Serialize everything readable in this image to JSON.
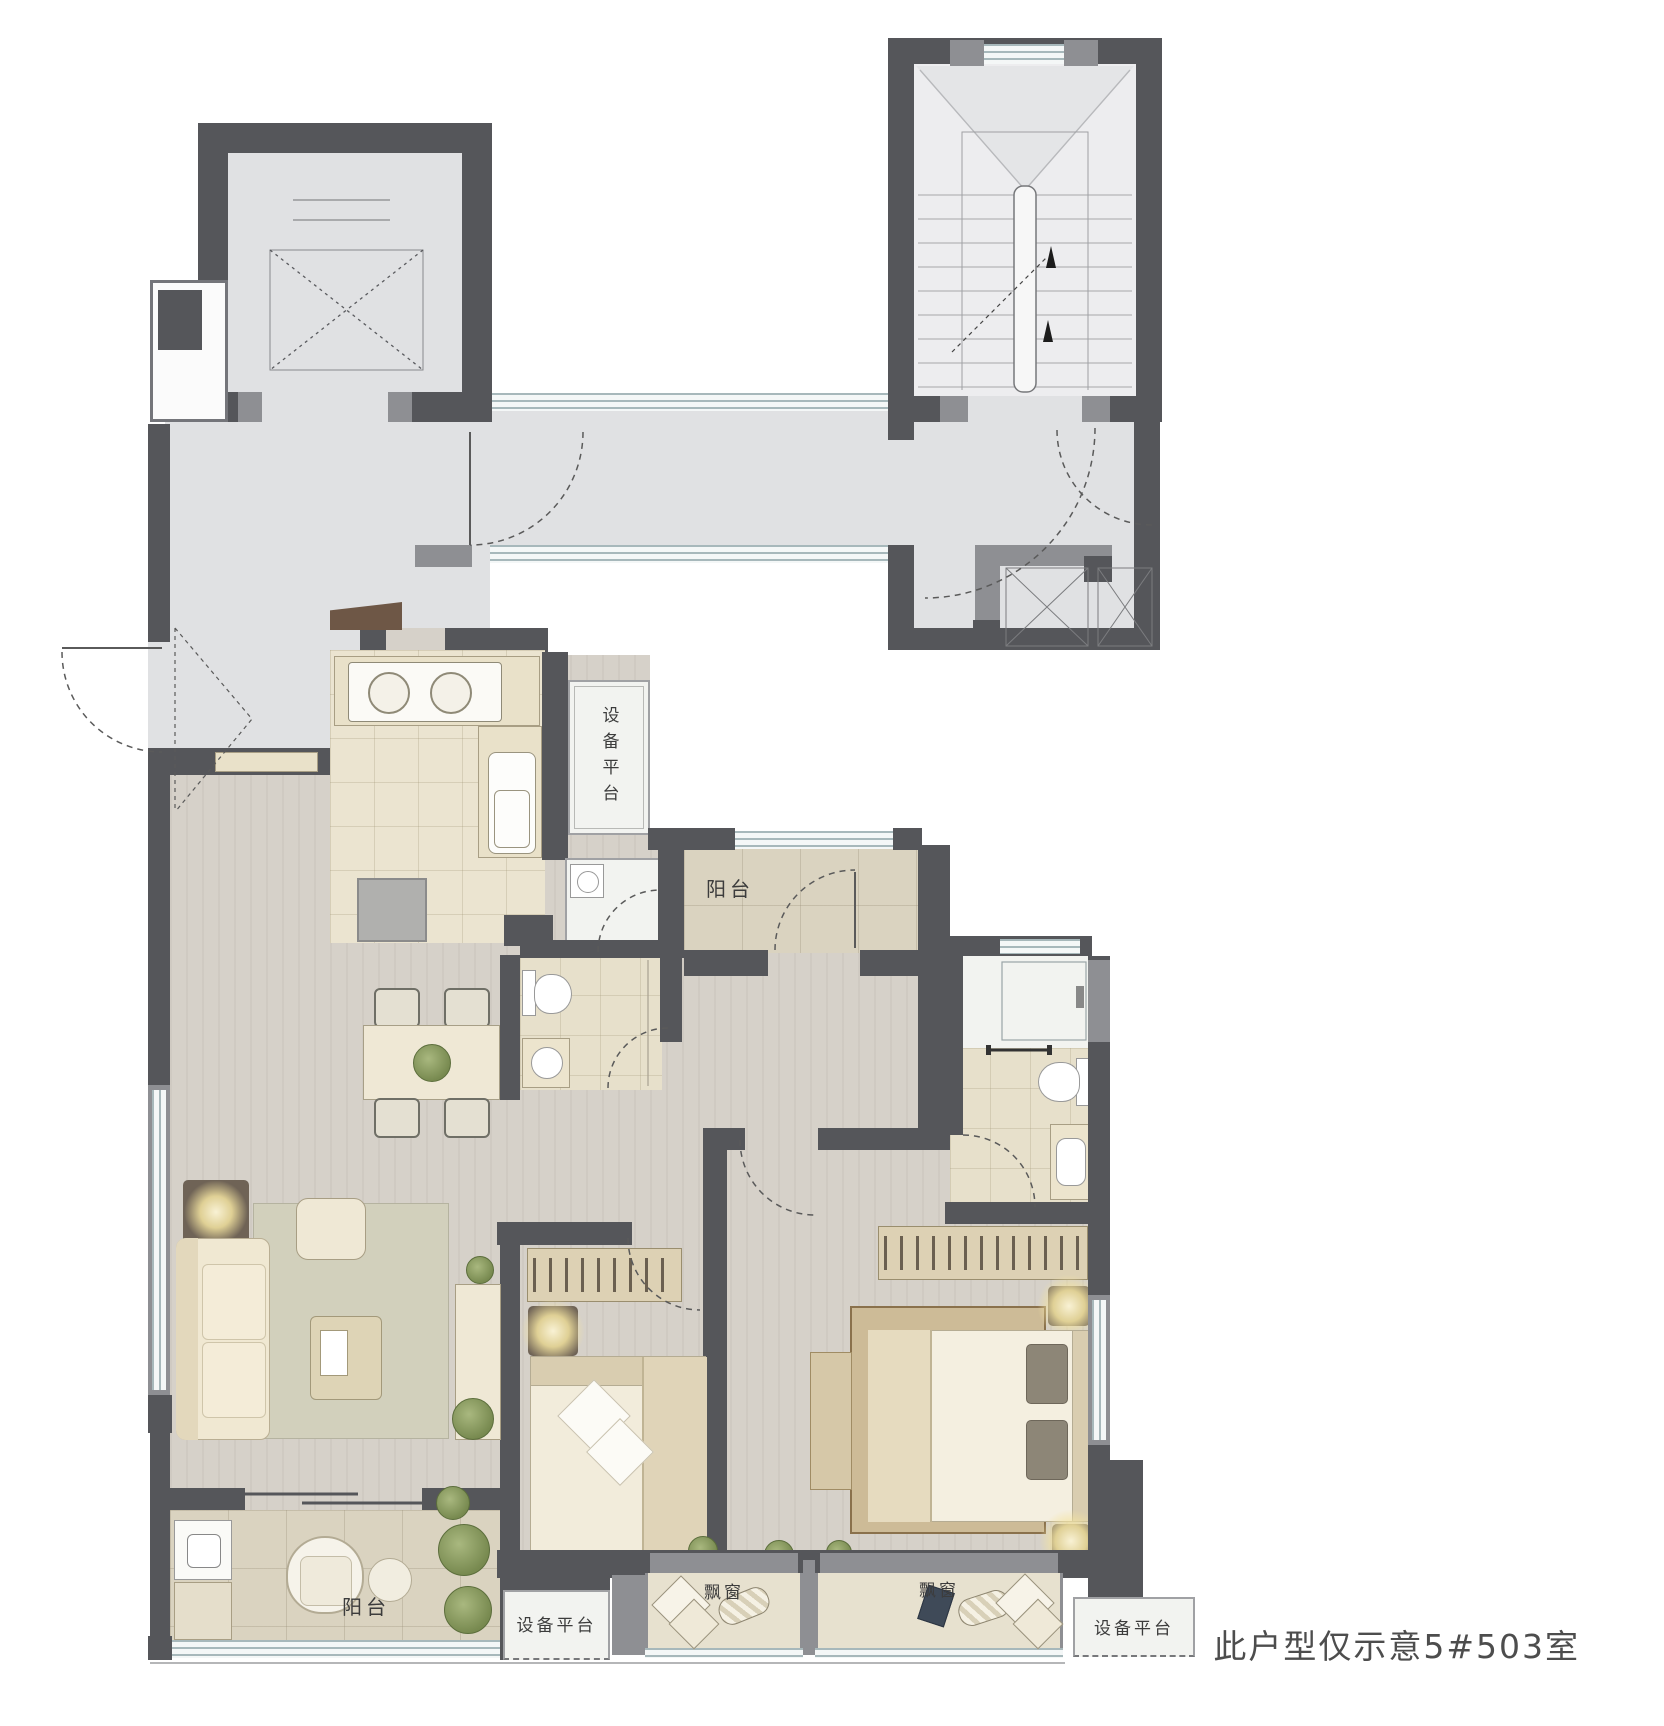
{
  "plan": {
    "unit_note": "此户型仅示意5#503室",
    "labels": {
      "equipment_platform_top": "设备平台",
      "balcony_top": "阳台",
      "balcony_bottom": "阳台",
      "bay_window_left": "飘窗",
      "bay_window_right": "飘窗",
      "equipment_platform_bottom_left": "设备平台",
      "equipment_platform_bottom_right": "设备平台"
    },
    "colors": {
      "wall_dark": "#55565a",
      "wall_medium": "#8e8f93",
      "public_floor": "#e0e1e3",
      "stair_floor": "#ededef",
      "wood_floor": "#d6d1c9",
      "kitchen_tile": "#ebe4d0",
      "bath_tile": "#e7e0cb",
      "balcony_tile": "#dad3c0",
      "white_room": "#f2f3f0",
      "window_line": "#a7b8bb",
      "label_text": "#3c3c3c",
      "note_text": "#4d4d4d"
    }
  }
}
